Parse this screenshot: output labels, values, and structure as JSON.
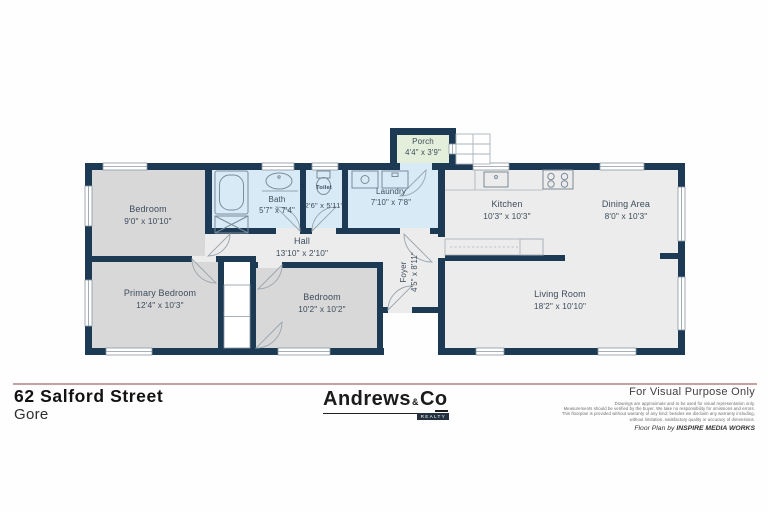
{
  "title_block": {
    "address_line1": "62 Salford Street",
    "address_line2": "Gore"
  },
  "agency": {
    "brand_main": "Andrews",
    "brand_amp": "&",
    "brand_c": "C",
    "brand_o": "o",
    "brand_sub": "REALTY"
  },
  "legal": {
    "visual_note": "For Visual Purpose Only",
    "disclaimer_lines": [
      "Drawings are approximate and to be used for visual representation only.",
      "Measurements should be verified by the buyer. We take no responsibility for omissions and errors.",
      "This floorplan is provided without warranty of any kind; besides we disclaim any warranty including,",
      "without limitation, satisfactory quality or accuracy of dimensions."
    ],
    "credit_prefix": "Floor Plan by ",
    "credit_brand": "INSPIRE MEDIA WORKS"
  },
  "floorplan": {
    "rooms": {
      "porch": {
        "name": "Porch",
        "dims": "4'4\" x 3'9\""
      },
      "bedroom1": {
        "name": "Bedroom",
        "dims": "9'0\" x 10'10\""
      },
      "bath": {
        "name": "Bath",
        "dims": "5'7\" x 7'4\""
      },
      "toilet": {
        "name": "Toilet",
        "dims": "2'6\" x 5'11\""
      },
      "laundry": {
        "name": "Laundry",
        "dims": "7'10\" x 7'8\""
      },
      "hall": {
        "name": "Hall",
        "dims": "13'10\" x 2'10\""
      },
      "kitchen": {
        "name": "Kitchen",
        "dims": "10'3\" x 10'3\""
      },
      "dining": {
        "name": "Dining Area",
        "dims": "8'0\" x 10'3\""
      },
      "foyer": {
        "name": "Foyer",
        "dims": "4'5\" x 8'11\""
      },
      "primary": {
        "name": "Primary Bedroom",
        "dims": "12'4\" x 10'3\""
      },
      "bedroom2": {
        "name": "Bedroom",
        "dims": "10'2\" x 10'2\""
      },
      "living": {
        "name": "Living Room",
        "dims": "18'2\" x 10'10\""
      }
    },
    "colors": {
      "wall": "#1c3a54",
      "bedroom_fill": "#d8d8d8",
      "living_fill": "#ececec",
      "wet_area_fill": "#d8eaf6",
      "porch_fill": "#e3efda",
      "divider": "#c7a0a0",
      "label_text": "#3d4c5c"
    }
  }
}
